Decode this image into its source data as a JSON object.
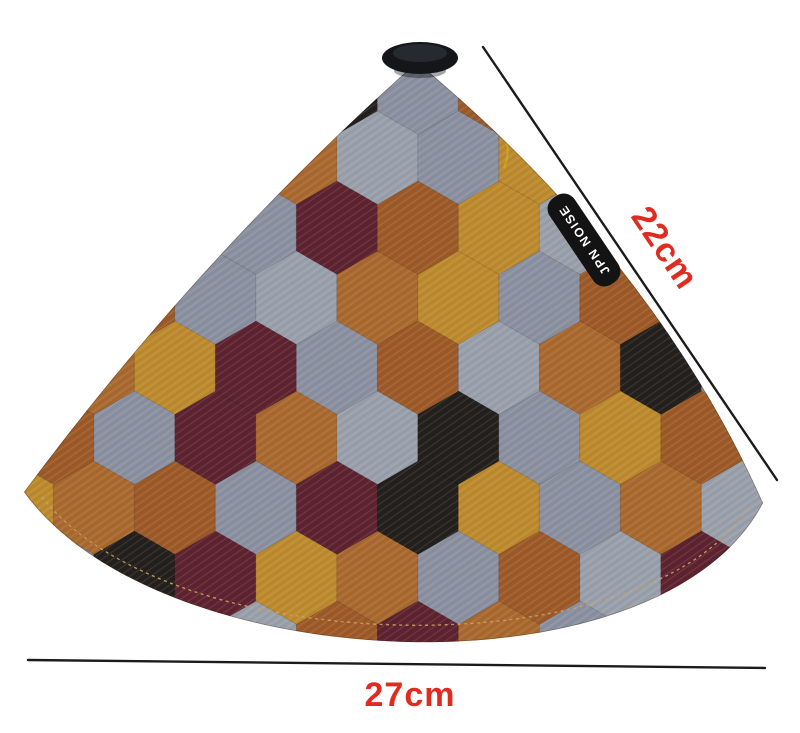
{
  "annotations": {
    "diagonal_label": "22cm",
    "bottom_label": "27cm",
    "label_color": "#e02b20",
    "line_color": "#1b1b1b"
  },
  "tag": {
    "label": "JPN NOISE",
    "bg": "#131313",
    "text_color": "#ffffff"
  },
  "cap": {
    "color": "#14161a",
    "highlight": "#343a42"
  },
  "fabric": {
    "lantern_text": "日本",
    "palette": [
      "#8b90a0",
      "#a9692f",
      "#bd8a2e",
      "#5e2330",
      "#23201d",
      "#9d5a28",
      "#9aa0ab",
      "#b02e24",
      "#c9a94f",
      "#f1e3c4"
    ],
    "rows": [
      "2013405162",
      "0351602418",
      "1040352601",
      "3506120534",
      "0123056140",
      "5031640252",
      "2150342016",
      "0432105631",
      "1206531042"
    ],
    "colors": {
      "white": "#fdfbf6",
      "ink": "#1d1a17",
      "red": "#c0392b",
      "deepred": "#8e1f1c",
      "gold": "#d9b84f",
      "goldline": "#a8872e",
      "brass": "#c9a227",
      "green": "#a2b934",
      "olive": "#6e7330",
      "cream": "#f3e2c2",
      "brown": "#8a5a33",
      "rust": "#9d5a28",
      "maroon": "#5e2330",
      "gray": "#8b90a0",
      "tan": "#c9a94f",
      "blush": "#e0907f",
      "stitch": "#caa05c"
    },
    "motifs": [
      {
        "type": "star",
        "col": 4,
        "row": 0
      },
      {
        "type": "warrior",
        "col": 5,
        "row": 0
      },
      {
        "type": "lantern",
        "col": 3,
        "row": 1
      },
      {
        "type": "cat",
        "col": 4,
        "row": 1
      },
      {
        "type": "target",
        "col": 5,
        "row": 1
      },
      {
        "type": "stripes",
        "col": 6,
        "row": 1
      },
      {
        "type": "shiba",
        "col": 4,
        "row": 2
      },
      {
        "type": "geisha",
        "col": 6,
        "row": 2
      },
      {
        "type": "daruma",
        "col": 7,
        "row": 2
      },
      {
        "type": "okame",
        "col": 4,
        "row": 3
      },
      {
        "type": "bird",
        "col": 5,
        "row": 3
      },
      {
        "type": "lanternflowers",
        "col": 6,
        "row": 3
      },
      {
        "type": "tiger",
        "col": 2,
        "row": 4
      },
      {
        "type": "plum",
        "col": 4,
        "row": 4
      },
      {
        "type": "fish",
        "col": 5,
        "row": 4
      },
      {
        "type": "okame",
        "col": 7,
        "row": 4
      },
      {
        "type": "triangles",
        "col": 8,
        "row": 4
      },
      {
        "type": "shippo",
        "col": 1,
        "row": 5
      },
      {
        "type": "checker",
        "col": 2,
        "row": 5
      },
      {
        "type": "star",
        "col": 3,
        "row": 5
      },
      {
        "type": "warrior",
        "col": 4,
        "row": 5
      },
      {
        "type": "tomoe",
        "col": 6,
        "row": 5
      },
      {
        "type": "catmask",
        "col": 7,
        "row": 5
      },
      {
        "type": "okame",
        "col": 1,
        "row": 6
      },
      {
        "type": "kabuki",
        "col": 2,
        "row": 6
      },
      {
        "type": "lantern",
        "col": 3,
        "row": 6
      },
      {
        "type": "cat",
        "col": 4,
        "row": 6
      },
      {
        "type": "target",
        "col": 5,
        "row": 6
      },
      {
        "type": "geisha",
        "col": 6,
        "row": 6
      },
      {
        "type": "tiger",
        "col": 7,
        "row": 6
      },
      {
        "type": "shiba",
        "col": 2,
        "row": 7
      },
      {
        "type": "stripes",
        "col": 4,
        "row": 7
      },
      {
        "type": "triangles",
        "col": 5,
        "row": 7
      },
      {
        "type": "daruma",
        "col": 6,
        "row": 7
      }
    ]
  }
}
